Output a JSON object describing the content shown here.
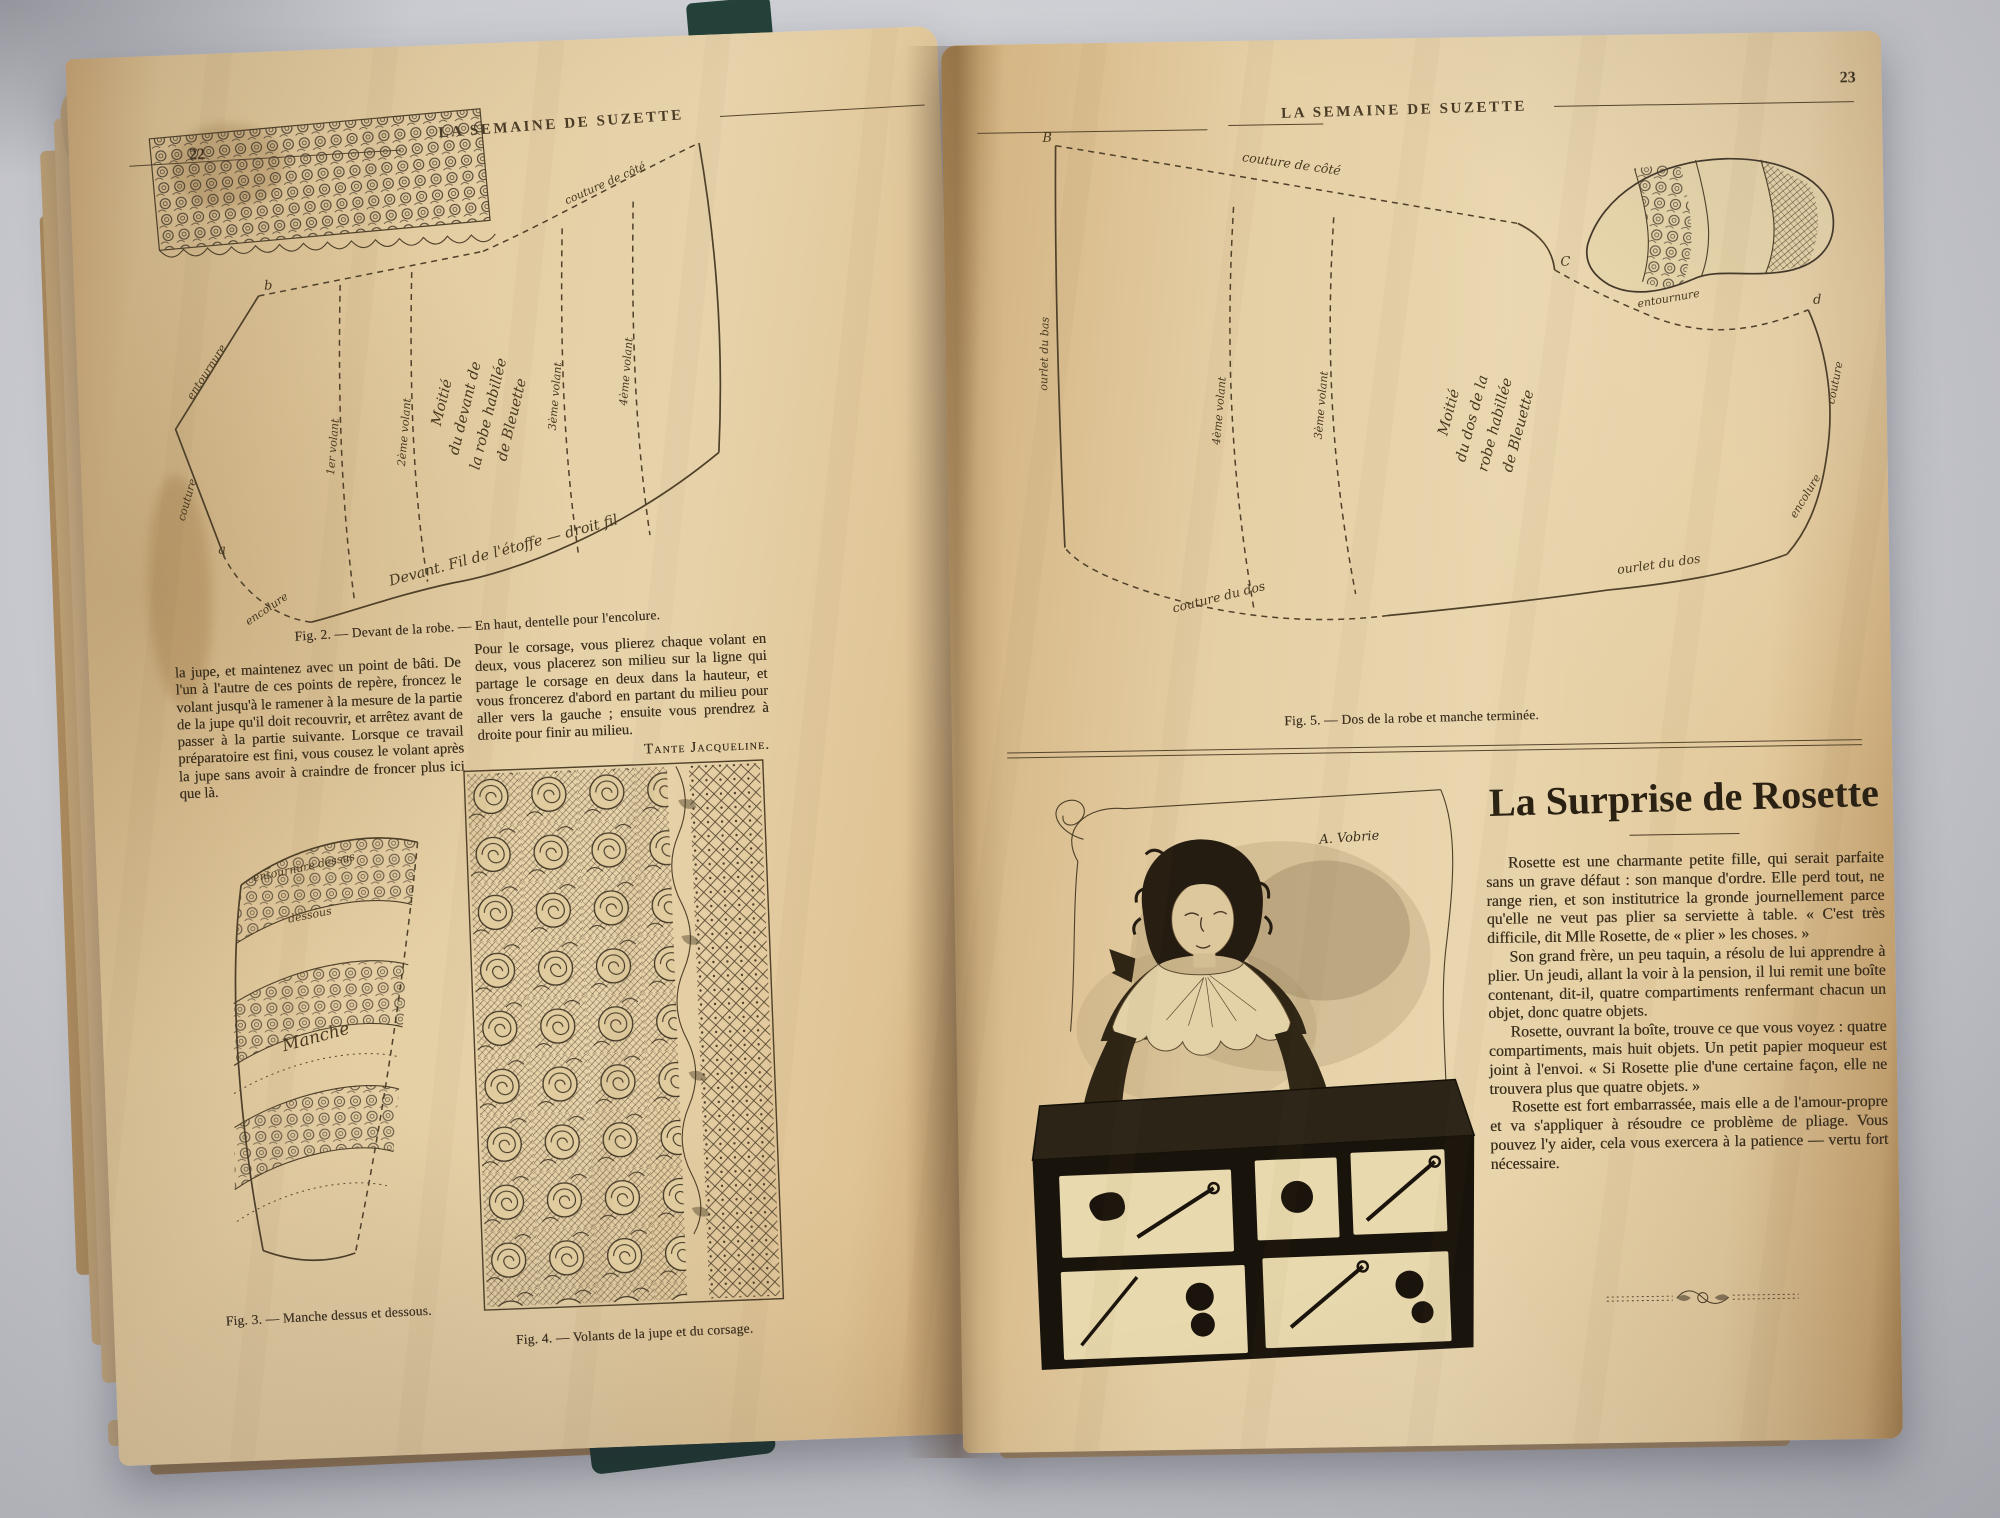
{
  "left_page": {
    "header": "LA SEMAINE DE SUZETTE",
    "page_number": "22",
    "fig2": {
      "caption": "Fig. 2. — Devant de la robe. — En haut, dentelle pour l'encolure.",
      "labels": {
        "corner_a": "a",
        "corner_b": "b",
        "couture": "couture",
        "entournure": "entournure",
        "encolure": "encolure",
        "couture_cote": "couture de côté",
        "v1": "1er volant",
        "v2": "2ème volant",
        "v3": "3ème volant",
        "v4": "4ème volant",
        "center1": "Moitié",
        "center2": "du devant de",
        "center3": "la robe habillée",
        "center4": "de Bleuette",
        "bottom": "Devant. Fil de l'étoffe — droit fil"
      }
    },
    "col1": "la jupe, et maintenez avec un point de bâti. De l'un à l'autre de ces points de repère, froncez le volant jusqu'à le ramener à la mesure de la partie de la jupe qu'il doit recouvrir, et arrêtez avant de passer à la partie suivante. Lorsque ce travail préparatoire est fini, vous cousez le volant après la jupe sans avoir à craindre de froncer plus ici que là.",
    "col2": "Pour le corsage, vous plierez chaque volant en deux, vous placerez son milieu sur la ligne qui partage le corsage en deux dans la hauteur, et vous froncerez d'abord en partant du milieu pour aller vers la gauche ; ensuite vous prendrez à droite pour finir au milieu.",
    "signature": "Tante Jacqueline.",
    "fig3": {
      "caption": "Fig. 3. — Manche dessus et dessous.",
      "labels": {
        "top": "entournure dessus",
        "mid": "dessous",
        "center": "Manche"
      }
    },
    "fig4": {
      "caption": "Fig. 4. — Volants de la jupe et du corsage."
    }
  },
  "right_page": {
    "header": "LA SEMAINE DE SUZETTE",
    "page_number": "23",
    "fig5": {
      "caption": "Fig. 5. — Dos de la robe et manche terminée.",
      "labels": {
        "corner_b": "B",
        "corner_c": "C",
        "corner_d": "d",
        "couture_cote": "couture de côté",
        "ourlet_bas": "ourlet du bas",
        "v4": "4ème volant",
        "v3": "3ème volant",
        "center1": "Moitié",
        "center2": "du dos de la",
        "center3": "robe habillée",
        "center4": "de Bleuette",
        "entournure": "entournure",
        "couture": "couture",
        "encolure": "encolure",
        "ourlet_dos": "ourlet du dos",
        "couture_dos": "couture du dos"
      }
    },
    "article": {
      "title": "La Surprise de Rosette",
      "illustrator_signature": "A. Vobrie",
      "paragraphs": [
        "Rosette est une charmante petite fille, qui serait parfaite sans un grave défaut : son manque d'ordre. Elle perd tout, ne range rien, et son institutrice la gronde journellement parce qu'elle ne veut pas plier sa serviette à table. « C'est très difficile, dit Mlle Rosette, de « plier » les choses. »",
        "Son grand frère, un peu taquin, a résolu de lui apprendre à plier. Un jeudi, allant la voir à la pension, il lui remit une boîte contenant, dit-il, quatre compartiments renfermant chacun un objet, donc quatre objets.",
        "Rosette, ouvrant la boîte, trouve ce que vous voyez : quatre compartiments, mais huit objets. Un petit papier moqueur est joint à l'envoi. « Si Rosette plie d'une certaine façon, elle ne trouvera plus que quatre objets. »",
        "Rosette est fort embarrassée, mais elle a de l'amour-propre et va s'appliquer à résoudre ce problème de pliage. Vous pouvez l'y aider, cela vous exercera à la patience — vertu fort nécessaire."
      ]
    }
  }
}
